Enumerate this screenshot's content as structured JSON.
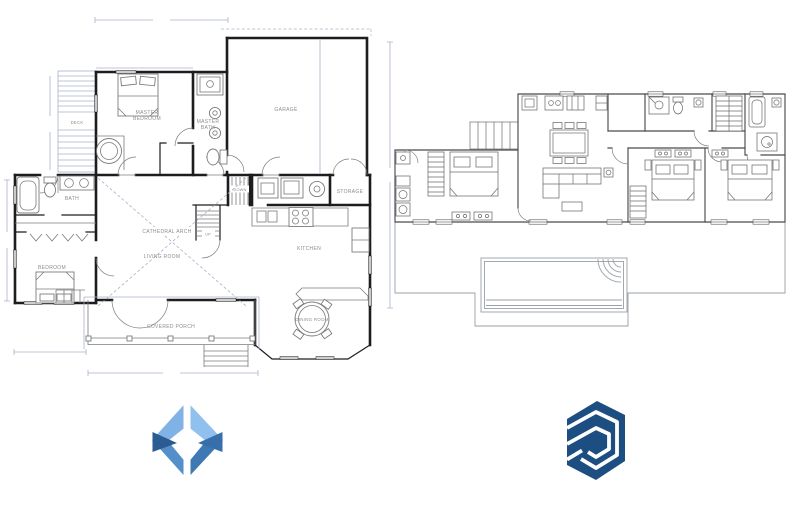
{
  "theme": {
    "background": "#ffffff",
    "plan_wall": "#1d1d1f",
    "plan_fixture": "#7c7c7c",
    "plan_light": "#a9b2ca",
    "plan_label": "#8d8d8d",
    "right_wall": "#4b4b4b",
    "right_furniture": "#6e6e6e",
    "right_patio": "#9aa0a6",
    "sd_light1": "#81b2e5",
    "sd_light2": "#8fc0ee",
    "sd_mid1": "#538fc9",
    "sd_mid2": "#3f79b3",
    "sd_dark1": "#2a5c92",
    "sd_dark2": "#366fa9",
    "sketchup_blue": "#1d4e82"
  },
  "left_plan": {
    "labels": {
      "deck": "DECK",
      "master_bedroom_1": "MASTER",
      "master_bedroom_2": "BEDROOM",
      "master_bath_1": "MASTER",
      "master_bath_2": "BATH",
      "garage": "GARAGE",
      "bath": "BATH",
      "bedroom": "BEDROOM",
      "living_room": "LIVING ROOM",
      "cathedral_arch": "CATHEDRAL ARCH",
      "kitchen": "KITCHEN",
      "storage": "STORAGE",
      "dining_room": "DINING ROOM",
      "covered_porch": "COVERED PORCH",
      "stairs_down": "DOWN",
      "stairs_up": "UP"
    }
  },
  "right_plan": {
    "labels": {}
  }
}
